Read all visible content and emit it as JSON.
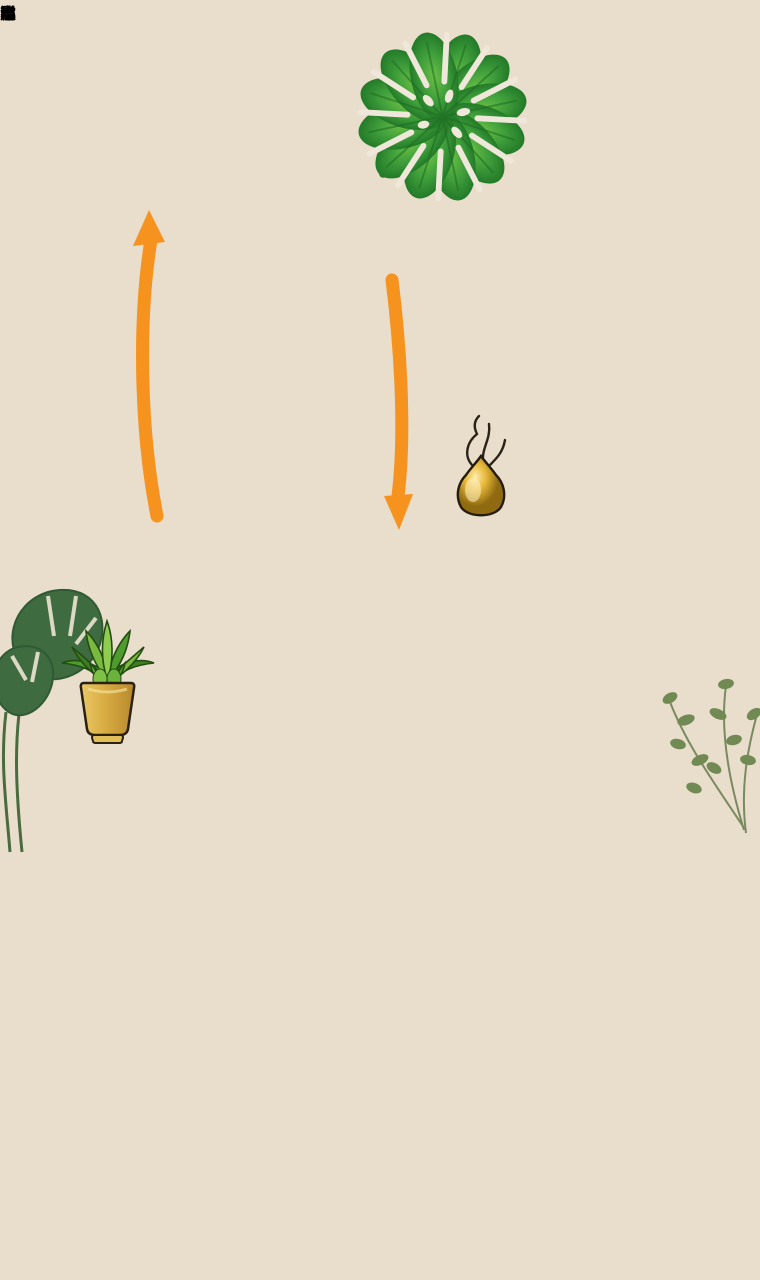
{
  "plan": {
    "title_chars": [
      "财",
      "位",
      "水",
      "布",
      "局"
    ],
    "cabinets": {
      "top": {
        "label": "市"
      },
      "left_upper": {
        "label": "沁"
      },
      "left_lower": {
        "label": "泣"
      },
      "right_upper": {
        "label": "淕"
      },
      "right_lower": {
        "label": "稱"
      }
    },
    "icons": {
      "monstera_leaf": "monstera-leaf",
      "potted_plant": "potted-aloe-in-gold-pot",
      "gold_gourd": "gold-gourd-with-incense-smoke",
      "up_arrow": "orange-curved-up-arrow",
      "down_arrow": "orange-curved-down-arrow",
      "windows": "gray-double-bar-window"
    },
    "colors": {
      "wall_black": "#17130e",
      "cabinet_wood": "#d9b98e",
      "interior_cream": "#f2ebde",
      "accent_orange": "#f6921e",
      "leaf_green": "#3f9e3b",
      "gold": "#d9a520",
      "window_gray": "#cfcfcb"
    }
  },
  "scene": {
    "description": "warm living-room photo backdrop",
    "elements": [
      "tray-ceiling-with-spotlights",
      "beige-curtain",
      "monstera-plant",
      "cream-armchair",
      "round-walnut-coffee-table",
      "white-books",
      "amber-bottle",
      "oak-floor",
      "beige-rug",
      "cream-pouf",
      "wood-sideboard",
      "white-vase-with-branches",
      "framed-art"
    ]
  }
}
